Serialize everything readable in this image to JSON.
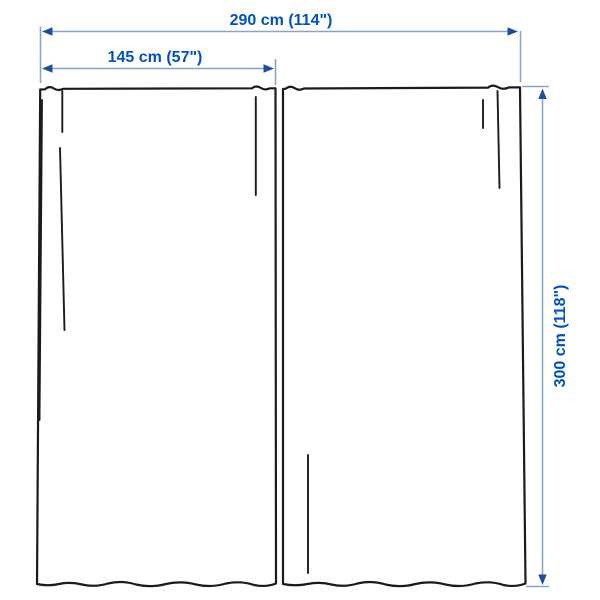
{
  "diagram": {
    "type": "product-dimension-diagram",
    "subject": "curtain-pair",
    "panel_count": 2,
    "dimensions": {
      "total_width": "290 cm (114\")",
      "panel_width": "145 cm (57\")",
      "height": "300 cm (118\")"
    }
  },
  "colors": {
    "label": "#0051BA",
    "dim-line": "#8CA3C7",
    "arrow": "#1F4C9C",
    "outline": "#1B1B1B",
    "background": "#FFFFFF"
  }
}
